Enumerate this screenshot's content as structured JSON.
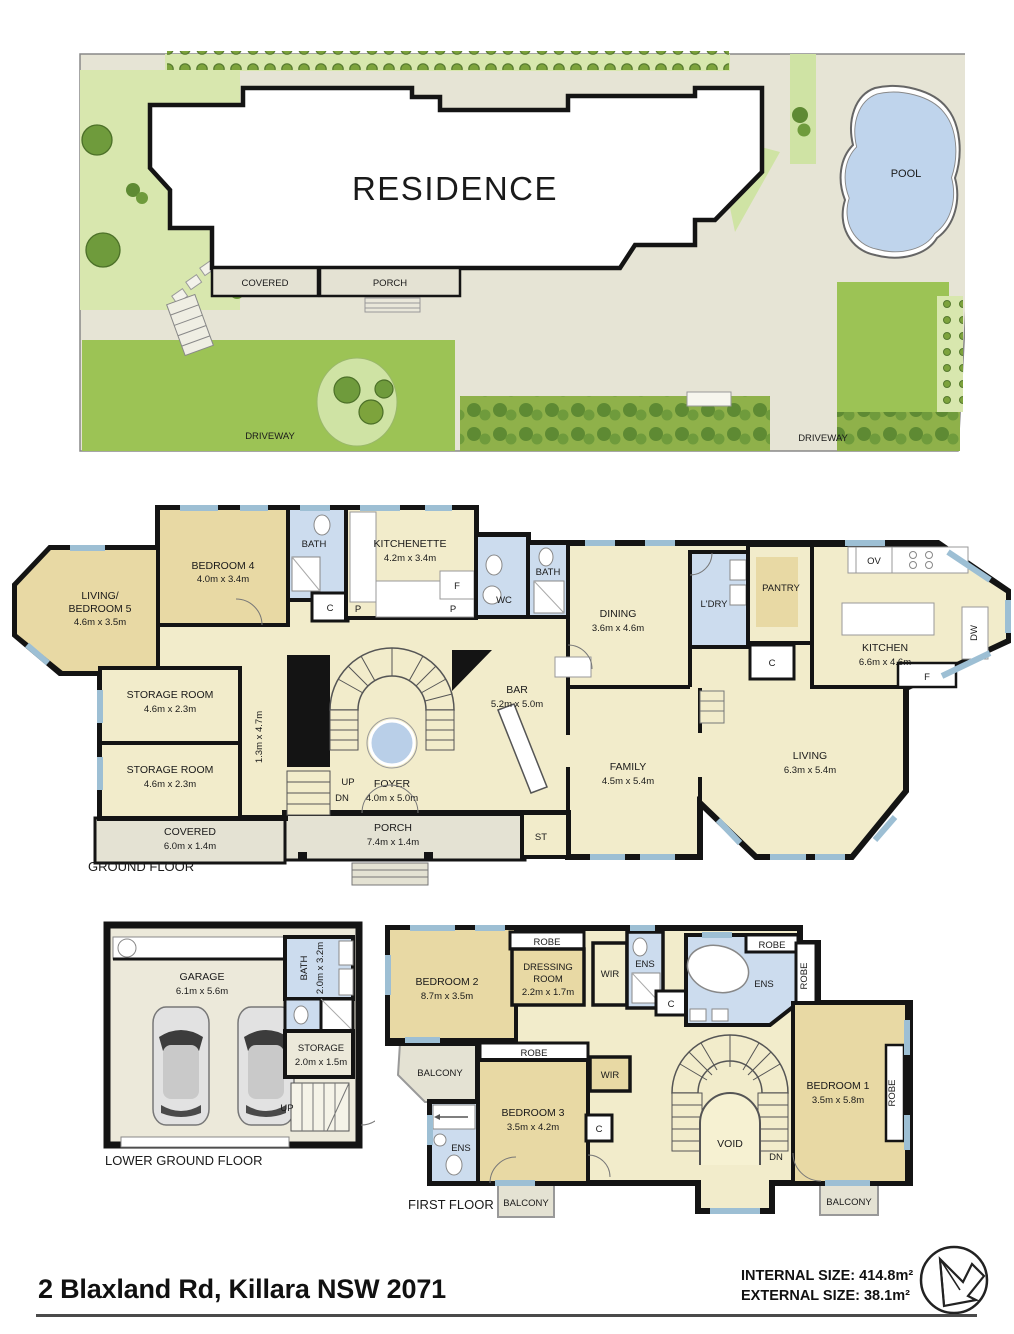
{
  "site": {
    "residence": "RESIDENCE",
    "pool": "POOL",
    "covered": "COVERED",
    "porch": "PORCH",
    "driveway_left": "DRIVEWAY",
    "driveway_right": "DRIVEWAY"
  },
  "ground": {
    "title": "GROUND FLOOR",
    "living5_1": "LIVING/",
    "living5_2": "BEDROOM 5",
    "living5_d": "4.6m x 3.5m",
    "bed4": "BEDROOM 4",
    "bed4_d": "4.0m x 3.4m",
    "bath1": "BATH",
    "c1": "C",
    "p1": "P",
    "kitchenette": "KITCHENETTE",
    "kitchenette_d": "4.2m x 3.4m",
    "f1": "F",
    "p2": "P",
    "wc": "WC",
    "bath2": "BATH",
    "dining": "DINING",
    "dining_d": "3.6m x 4.6m",
    "ldry": "L'DRY",
    "pantry": "PANTRY",
    "c2": "C",
    "ov": "OV",
    "dw": "DW",
    "f2": "F",
    "kitchen": "KITCHEN",
    "kitchen_d": "6.6m x 4.6m",
    "storage1": "STORAGE ROOM",
    "storage1_d": "4.6m x 2.3m",
    "storage2": "STORAGE ROOM",
    "storage2_d": "4.6m x 2.3m",
    "hall_d": "1.3m x 4.7m",
    "foyer": "FOYER",
    "foyer_d": "4.0m x 5.0m",
    "up": "UP",
    "dn": "DN",
    "bar": "BAR",
    "bar_d": "5.2m x 5.0m",
    "family": "FAMILY",
    "family_d": "4.5m x 5.4m",
    "living": "LIVING",
    "living_d": "6.3m x 5.4m",
    "covered": "COVERED",
    "covered_d": "6.0m x 1.4m",
    "porch": "PORCH",
    "porch_d": "7.4m x 1.4m",
    "st": "ST"
  },
  "lower": {
    "title": "LOWER GROUND FLOOR",
    "garage": "GARAGE",
    "garage_d": "6.1m x 5.6m",
    "bath": "BATH",
    "bath_d": "2.0m x 3.2m",
    "storage": "STORAGE",
    "storage_d": "2.0m x 1.5m",
    "up": "UP"
  },
  "first": {
    "title": "FIRST FLOOR",
    "bed2": "BEDROOM 2",
    "bed2_d": "8.7m x 3.5m",
    "robe1": "ROBE",
    "dress1": "DRESSING",
    "dress2": "ROOM",
    "dress_d": "2.2m x 1.7m",
    "wir1": "WIR",
    "ens1": "ENS",
    "c1": "C",
    "ens2": "ENS",
    "robe2": "ROBE",
    "robe3": "ROBE",
    "bed1": "BEDROOM 1",
    "bed1_d": "3.5m x 5.8m",
    "robe5": "ROBE",
    "void": "VOID",
    "dn": "DN",
    "balc1": "BALCONY",
    "robe4": "ROBE",
    "wir2": "WIR",
    "bed3": "BEDROOM 3",
    "bed3_d": "3.5m x 4.2m",
    "c2": "C",
    "ens3": "ENS",
    "balc2": "BALCONY",
    "balc3": "BALCONY"
  },
  "footer": {
    "address": "2 Blaxland Rd, Killara NSW 2071",
    "internal": "INTERNAL SIZE: 414.8m²",
    "external": "EXTERNAL SIZE: 38.1m²"
  },
  "colors": {
    "wall": "#141414",
    "room_cream": "#f2eccb",
    "room_tan": "#e8d9a4",
    "wet_blue": "#ccdcee",
    "outdoor_grey": "#e4e2d3",
    "grass_light": "#d8e7ae",
    "grass_mid": "#9cc355",
    "hedge_green": "#8fb14a",
    "pool_blue": "#bfd4ec",
    "window_blue": "#9dbfd4"
  }
}
